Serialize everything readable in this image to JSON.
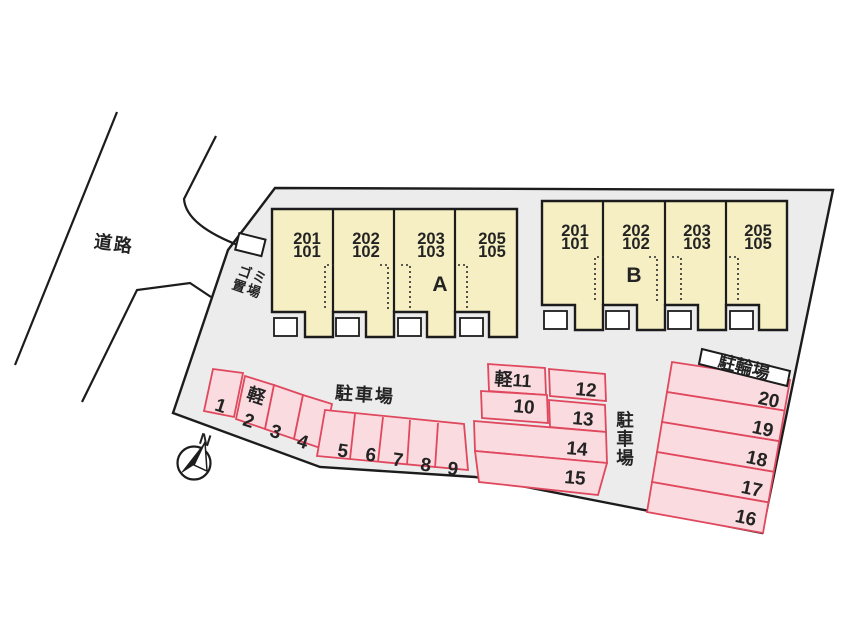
{
  "road": {
    "label": "道路"
  },
  "garbage_area": {
    "label_line1": "ゴミ",
    "label_line2": "置場"
  },
  "compass": {
    "north_label": "N"
  },
  "buildings": {
    "a": {
      "label": "A",
      "units": [
        {
          "upper": "201",
          "lower": "101"
        },
        {
          "upper": "202",
          "lower": "102"
        },
        {
          "upper": "203",
          "lower": "103"
        },
        {
          "upper": "205",
          "lower": "105"
        }
      ]
    },
    "b": {
      "label": "B",
      "units": [
        {
          "upper": "201",
          "lower": "101"
        },
        {
          "upper": "202",
          "lower": "102"
        },
        {
          "upper": "203",
          "lower": "103"
        },
        {
          "upper": "205",
          "lower": "105"
        }
      ]
    }
  },
  "parking": {
    "lot_label": "駐車場",
    "lot_label_vertical": [
      "駐",
      "車",
      "場"
    ],
    "kei_label": "軽",
    "row1_stalls": [
      "1",
      "2",
      "3",
      "4"
    ],
    "row2_stalls": [
      "5",
      "6",
      "7",
      "8",
      "9"
    ],
    "middle_stalls": {
      "kei11": "軽11",
      "s10": "10",
      "s12": "12",
      "s13": "13",
      "s14": "14",
      "s15": "15"
    },
    "right_stalls": [
      "20",
      "19",
      "18",
      "17",
      "16"
    ]
  },
  "bicycle_parking": {
    "label": "駐輪場"
  },
  "colors": {
    "site_fill": "#ececec",
    "building_fill": "#f5efc3",
    "stall_fill": "#fadbe0",
    "stall_stroke": "#e0485e",
    "line": "#1c1c1c"
  }
}
